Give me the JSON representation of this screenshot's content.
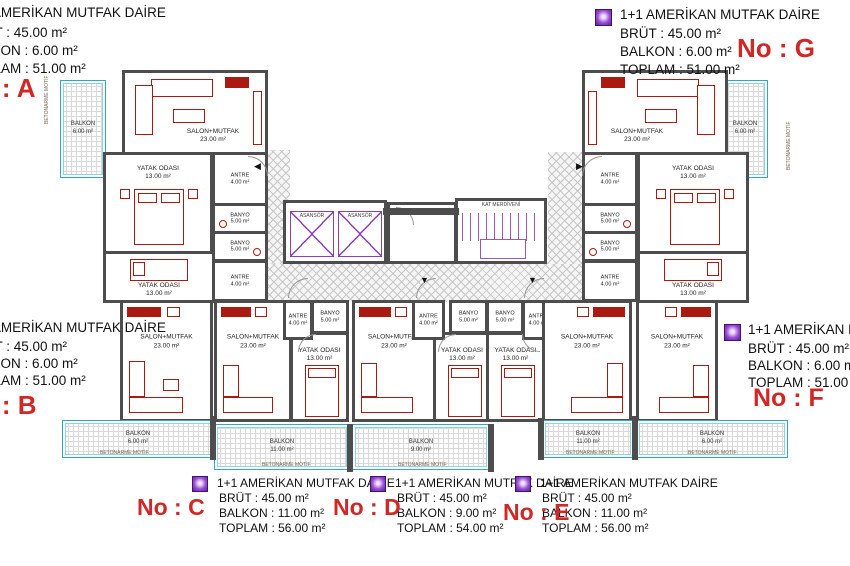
{
  "watermark": "ATABERK",
  "colors": {
    "wall": "#4d4d4d",
    "furniture": "#ab1a10",
    "balcony_border": "#2fa8c2",
    "core_purple": "#8a3fb5",
    "no_label_red": "#d02727",
    "hatch": "#c7c7c7",
    "watermark_blue": "#7daad4"
  },
  "info_blocks": [
    {
      "id": "A",
      "title": "1+1 AMERİKAN MUTFAK DAİRE",
      "brut": "BRÜT : 45.00 m²",
      "balkon": "BALKON : 6.00 m²",
      "toplam": "TOPLAM : 51.00 m²",
      "no": "No : A"
    },
    {
      "id": "G",
      "title": "1+1 AMERİKAN MUTFAK DAİRE",
      "brut": "BRÜT : 45.00 m²",
      "balkon": "BALKON : 6.00 m²",
      "toplam": "TOPLAM : 51.00 m²",
      "no": "No : G"
    },
    {
      "id": "B",
      "title": "1+1 AMERİKAN MUTFAK DAİRE",
      "brut": "BRÜT : 45.00 m²",
      "balkon": "BALKON : 6.00 m²",
      "toplam": "TOPLAM : 51.00 m²",
      "no": "No : B"
    },
    {
      "id": "F",
      "title": "1+1 AMERİKAN MUTFAK DAİRE",
      "brut": "BRÜT : 45.00 m²",
      "balkon": "BALKON : 6.00 m²",
      "toplam": "TOPLAM : 51.00 m²",
      "no": "No : F"
    },
    {
      "id": "C",
      "title": "1+1 AMERİKAN MUTFAK DAİRE",
      "brut": "BRÜT : 45.00 m²",
      "balkon": "BALKON : 11.00 m²",
      "toplam": "TOPLAM : 56.00 m²",
      "no": "No : C"
    },
    {
      "id": "D",
      "title": "1+1 AMERİKAN MUTFAK DAİRE",
      "brut": "BRÜT : 45.00 m²",
      "balkon": "BALKON : 9.00 m²",
      "toplam": "TOPLAM : 54.00 m²",
      "no": "No : D"
    },
    {
      "id": "E",
      "title": "1+1 AMERİKAN MUTFAK DAİRE",
      "brut": "BRÜT : 45.00 m²",
      "balkon": "BALKON : 11.00 m²",
      "toplam": "TOPLAM : 56.00 m²",
      "no": "No : E"
    }
  ],
  "rooms": {
    "salon": "SALON+MUTFAK",
    "salon_area": "23.00 m²",
    "bedroom": "YATAK ODASI",
    "bedroom_area": "13.00 m²",
    "antre": "ANTRE",
    "antre_area": "4.00 m²",
    "banyo": "BANYO",
    "banyo_area": "5.00 m²",
    "balkon": "BALKON"
  },
  "balconies": {
    "a": "6.00 m²",
    "b": "6.00 m²",
    "c": "11.00 m²",
    "d": "9.00 m²",
    "e": "11.00 m²",
    "f": "6.00 m²",
    "g": "6.00 m²"
  },
  "core": {
    "elevator": "ASANSÖR",
    "stairs": "KAT MERDİVENİ"
  },
  "notes": {
    "edge": "BETONARME MOTİF"
  }
}
